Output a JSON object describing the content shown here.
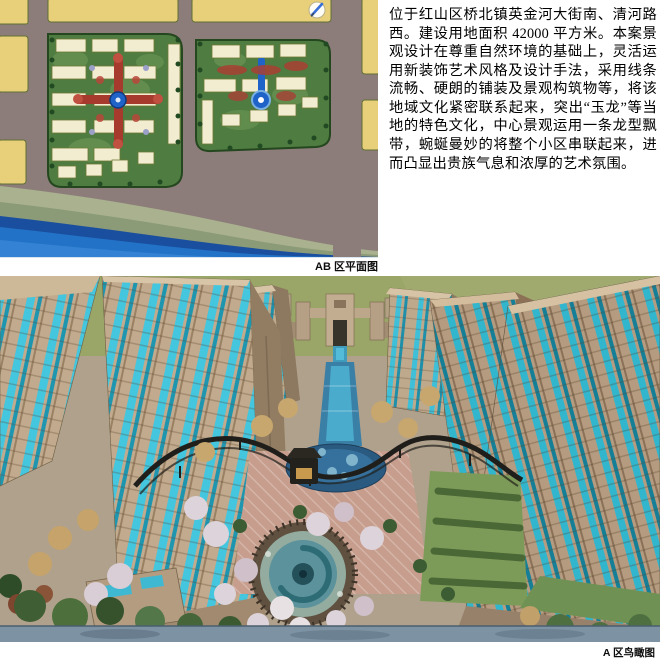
{
  "description": {
    "text": "位于红山区桥北镇英金河大街南、清河路西。建设用地面积 42000 平方米。本案景观设计在尊重自然环境的基础上，灵活运用新装饰艺术风格及设计手法，采用线条流畅、硬朗的铺装及景观构筑物等，将该地域文化紧密联系起来，突出“玉龙”等当地的特色文化，中心景观运用一条龙型飘带，蜿蜒曼妙的将整个小区串联起来，进而凸显出贵族气息和浓厚的艺术氛围。"
  },
  "figures": {
    "site_plan": {
      "caption": "AB 区平面图",
      "icon": "pencil-icon"
    },
    "aerial_view": {
      "caption": "A 区鸟瞰图"
    }
  },
  "colors": {
    "road_mauve": "#8d7d7a",
    "block_yellow": "#e8d07b",
    "parcel_green": "#4f7c41",
    "river_blue": "#2273c8",
    "river_dark_edge": "#1a4f9f",
    "bank_green": "#a9b18e",
    "tower_tan": "#c1aa8d",
    "glass_cyan": "#43c6de",
    "glass_teal": "#1f96b0",
    "ground_olive": "#9aa568",
    "axis_red": "#a63a2c",
    "axis_blue": "#1f63c9"
  }
}
